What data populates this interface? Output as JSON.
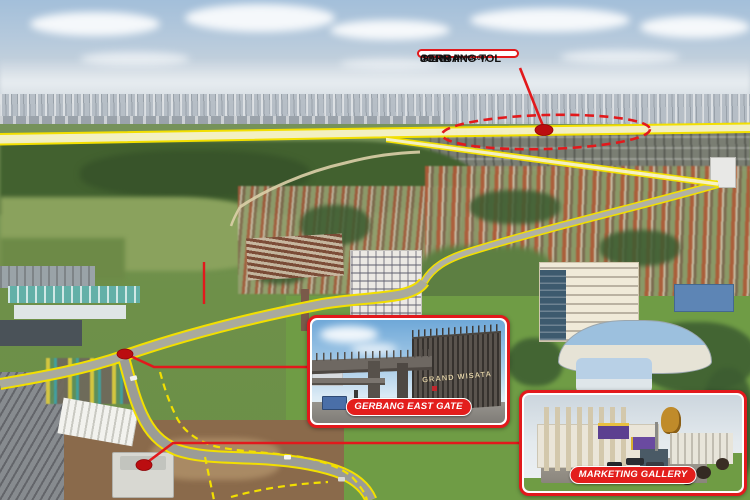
{
  "annotations": {
    "toll_gate_callout": {
      "line1": "GERBANG TOL",
      "line2": "JORR II",
      "line3": "(Setu Utara MM2100)"
    },
    "east_gate_inset": {
      "label": "GERBANG EAST GATE",
      "gate_sign": "GRAND WISATA"
    },
    "marketing_gallery_inset": {
      "label": "MARKETING GALLERY"
    }
  },
  "colors": {
    "annotation_red": "#e2191c",
    "pill_red": "#e31e1c",
    "dot_red": "#bb0d10",
    "highlight_yellow": "#f2df00",
    "highlight_fill": "#faf5c8",
    "callout_bg": "#ffffff",
    "callout_text": "#111111"
  }
}
